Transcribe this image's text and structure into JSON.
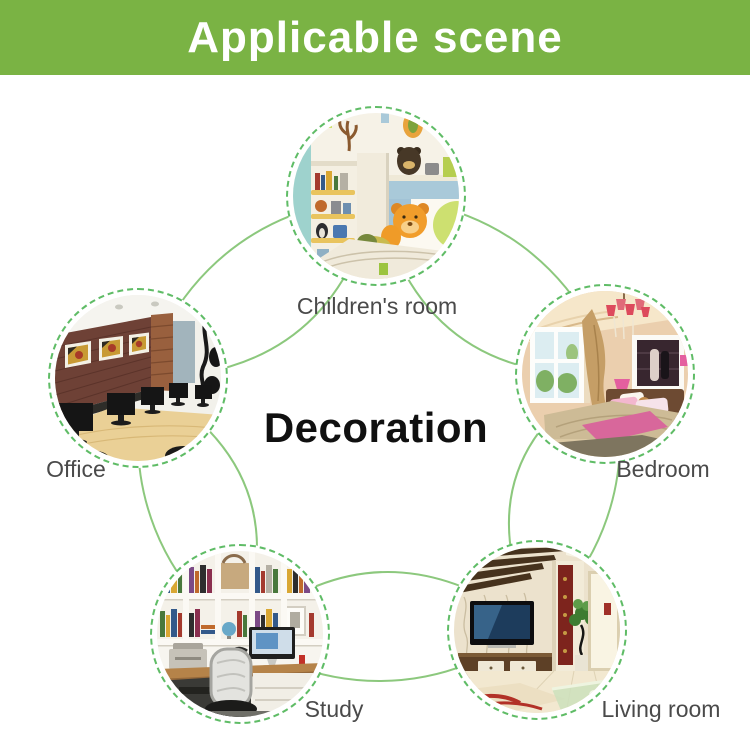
{
  "header": {
    "title": "Applicable scene",
    "bg_color": "#7ab344",
    "text_color": "#ffffff"
  },
  "center": {
    "label": "Decoration",
    "text_color": "#101010"
  },
  "diagram": {
    "connector_color": "#8cc87d",
    "ring_style": "dashed",
    "ring_color": "#5fbc66",
    "label_color": "#4a4a4a"
  },
  "scenes": [
    {
      "id": "children-room",
      "label": "Children's room",
      "photo_alt": "children's room with bear plush on bed and toy shelves"
    },
    {
      "id": "bedroom",
      "label": "Bedroom",
      "photo_alt": "bedroom with pink accents, chandelier and window"
    },
    {
      "id": "living-room",
      "label": "Living room",
      "photo_alt": "living room with wall TV, cabinet and plant"
    },
    {
      "id": "study",
      "label": "Study",
      "photo_alt": "study with bookshelves, desk computer and chair"
    },
    {
      "id": "office",
      "label": "Office",
      "photo_alt": "office with wood wall, framed pictures and monitors"
    }
  ]
}
